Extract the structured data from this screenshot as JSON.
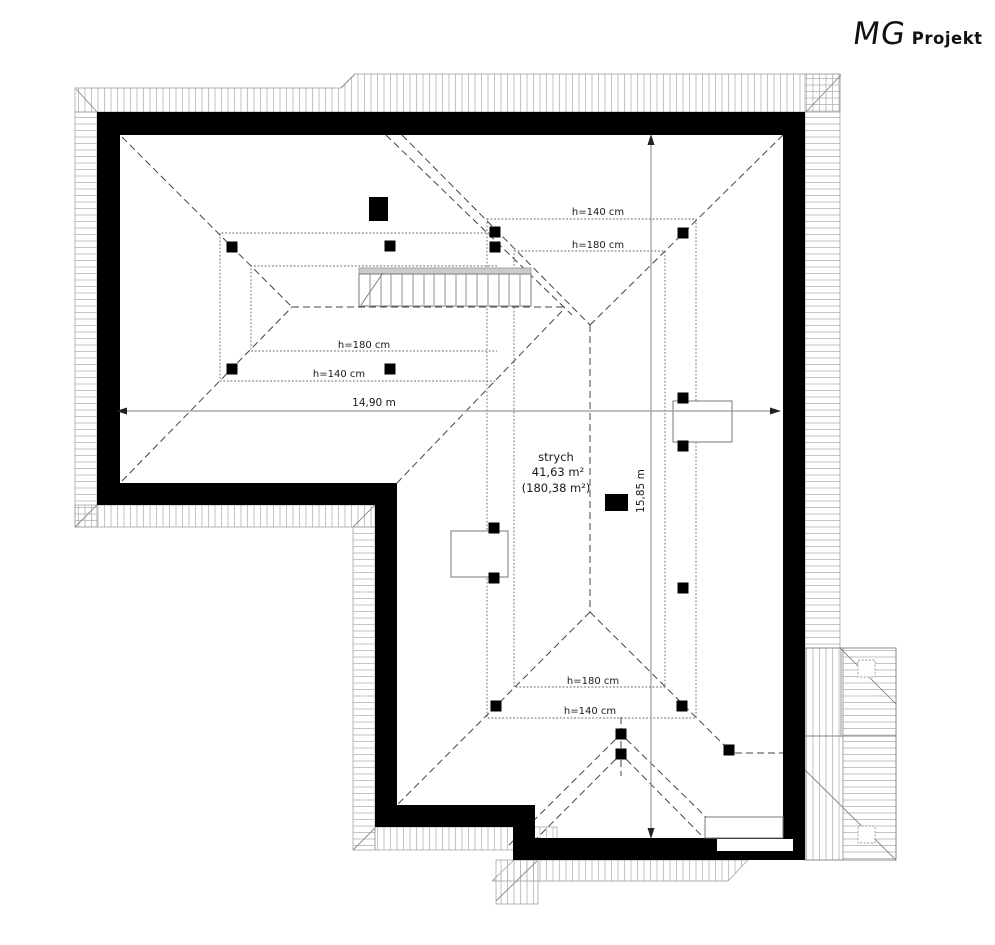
{
  "logo": {
    "mg": "MG",
    "projekt": "Projekt"
  },
  "room": {
    "name": "strych",
    "area_usable": "41,63 m²",
    "area_total": "(180,38 m²)"
  },
  "dimensions": {
    "width": "14,90 m",
    "depth": "15,85 m"
  },
  "heights": {
    "h140": "h=140 cm",
    "h180": "h=180 cm"
  }
}
